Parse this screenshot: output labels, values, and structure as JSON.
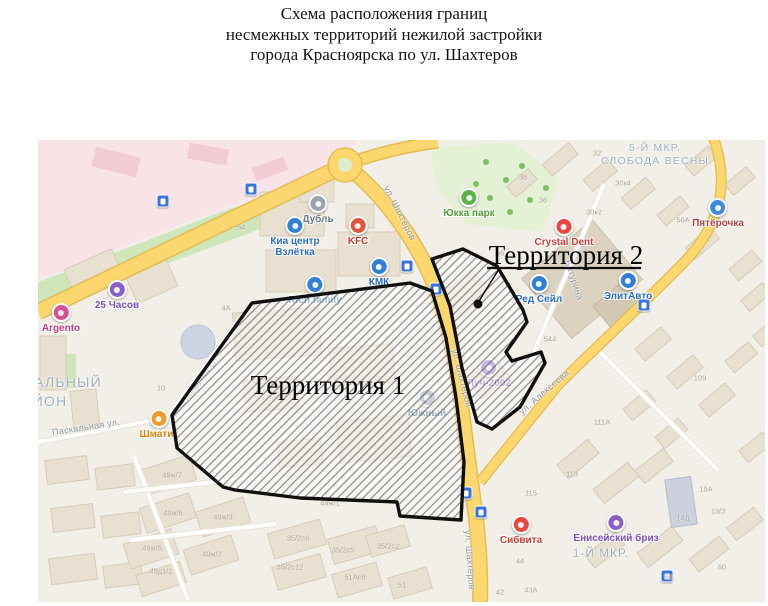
{
  "title": {
    "line1": "Схема расположения границ",
    "line2": "несмежных территорий нежилой застройки",
    "line3": "города Красноярска по ул. Шахтеров"
  },
  "territory_labels": [
    {
      "label": "Территория 1",
      "x": 290,
      "y": 230
    },
    {
      "label": "Территория 2",
      "x": 528,
      "y": 100
    }
  ],
  "district_labels": [
    {
      "t": "5-Й МКР.",
      "x": 617,
      "y": 2,
      "size": 10.5
    },
    {
      "t": "СЛОБОДА ВЕСНЫ",
      "x": 617,
      "y": 15,
      "size": 10.5
    },
    {
      "t": "1-Й МКР.",
      "x": 563,
      "y": 408,
      "size": 11.5
    },
    {
      "t": "АЛЬНЫЙ",
      "x": 30,
      "y": 234,
      "size": 14
    },
    {
      "t": "ЙОН",
      "x": 12,
      "y": 253,
      "size": 14
    }
  ],
  "street_labels": [
    {
      "t": "ул. Шахтёров",
      "x": 362,
      "y": 73,
      "rot": 63
    },
    {
      "t": "ул. Шахтёров",
      "x": 424,
      "y": 238,
      "rot": 76
    },
    {
      "t": "ул. Шахтёров",
      "x": 432,
      "y": 420,
      "rot": 86
    },
    {
      "t": "ул. Алексеева",
      "x": 506,
      "y": 252,
      "rot": -41
    },
    {
      "t": "Батурина",
      "x": 536,
      "y": 140,
      "rot": 72
    },
    {
      "t": "Абытаевская ул.",
      "x": 158,
      "y": 246,
      "rot": -53
    },
    {
      "t": "Паскальная ул.",
      "x": 48,
      "y": 287,
      "rot": -9
    }
  ],
  "pois": [
    {
      "t": "25 Часов",
      "x": 79,
      "y": 148,
      "c": "#8a5fc8",
      "lc": "#7a4fc0"
    },
    {
      "t": "Argento",
      "x": 23,
      "y": 171,
      "c": "#d94f93",
      "lc": "#c43c80"
    },
    {
      "t": "Шматик",
      "x": 121,
      "y": 277,
      "c": "#ef9a2e",
      "lc": "#d9820f"
    },
    {
      "t": "Дубль",
      "x": 280,
      "y": 62,
      "c": "#9aa3ab",
      "lc": "#6e7a85"
    },
    {
      "t": "Киа центр",
      "t2": "Взлётка",
      "x": 257,
      "y": 84,
      "c": "#2f80d6",
      "lc": "#2a6fc0"
    },
    {
      "t": "KFC",
      "x": 320,
      "y": 84,
      "c": "#e2543a",
      "lc": "#c23b2e"
    },
    {
      "t": "КМК",
      "x": 341,
      "y": 125,
      "c": "#2f80d6",
      "lc": "#2a6fc0"
    },
    {
      "t": "Rich family",
      "x": 277,
      "y": 143,
      "c": "#2f80d6",
      "lc": "#2a6fc0"
    },
    {
      "t": "Юкка парк",
      "x": 431,
      "y": 56,
      "c": "#59b347",
      "lc": "#4e9e38"
    },
    {
      "t": "Crystal Dent",
      "x": 526,
      "y": 85,
      "c": "#e8473f",
      "lc": "#d63c35"
    },
    {
      "t": "Пятёрочка",
      "x": 680,
      "y": 66,
      "c": "#3f8ae0",
      "lc": "#b0443c"
    },
    {
      "t": "Ред Сейл",
      "x": 501,
      "y": 142,
      "c": "#2f80d6",
      "lc": "#2a6fc0"
    },
    {
      "t": "ЭлитАвто",
      "x": 590,
      "y": 139,
      "c": "#2f80d6",
      "lc": "#2a6fc0"
    },
    {
      "t": "Луч-2002",
      "x": 451,
      "y": 226,
      "c": "#8a5fc8",
      "lc": "#7a4fc0"
    },
    {
      "t": "Южный",
      "x": 389,
      "y": 256,
      "c": "#8d99a3",
      "lc": "#33566e"
    },
    {
      "t": "Сибвита",
      "x": 483,
      "y": 383,
      "c": "#e8473f",
      "lc": "#d63c35"
    },
    {
      "t": "Енисейский бриз",
      "x": 578,
      "y": 381,
      "c": "#8a5fc8",
      "lc": "#7a4fc0"
    }
  ],
  "house_numbers": [
    {
      "t": "32",
      "x": 559,
      "y": 13
    },
    {
      "t": "30к4",
      "x": 585,
      "y": 43
    },
    {
      "t": "30к2",
      "x": 556,
      "y": 72
    },
    {
      "t": "50А",
      "x": 645,
      "y": 80
    },
    {
      "t": "36",
      "x": 505,
      "y": 60
    },
    {
      "t": "38",
      "x": 485,
      "y": 37
    },
    {
      "t": "66",
      "x": 462,
      "y": 113
    },
    {
      "t": "54",
      "x": 203,
      "y": 87
    },
    {
      "t": "544",
      "x": 512,
      "y": 199
    },
    {
      "t": "109",
      "x": 662,
      "y": 238
    },
    {
      "t": "111А",
      "x": 564,
      "y": 282
    },
    {
      "t": "113",
      "x": 534,
      "y": 334
    },
    {
      "t": "115",
      "x": 493,
      "y": 353
    },
    {
      "t": "19А",
      "x": 668,
      "y": 349
    },
    {
      "t": "19/3",
      "x": 680,
      "y": 371
    },
    {
      "t": "14Д",
      "x": 645,
      "y": 378
    },
    {
      "t": "60",
      "x": 684,
      "y": 427
    },
    {
      "t": "62",
      "x": 631,
      "y": 437
    },
    {
      "t": "44",
      "x": 482,
      "y": 421
    },
    {
      "t": "43А",
      "x": 493,
      "y": 450
    },
    {
      "t": "42",
      "x": 462,
      "y": 452
    },
    {
      "t": "4А",
      "x": 188,
      "y": 168
    },
    {
      "t": "10",
      "x": 123,
      "y": 248
    },
    {
      "t": "49ж/7",
      "x": 134,
      "y": 335
    },
    {
      "t": "49ж/6",
      "x": 135,
      "y": 373
    },
    {
      "t": "49ж/3",
      "x": 185,
      "y": 377
    },
    {
      "t": "49ж/5",
      "x": 114,
      "y": 408
    },
    {
      "t": "49ж/2",
      "x": 174,
      "y": 414
    },
    {
      "t": "49д1/2",
      "x": 123,
      "y": 431
    },
    {
      "t": "35/2с12",
      "x": 252,
      "y": 427
    },
    {
      "t": "35/2с6",
      "x": 260,
      "y": 398
    },
    {
      "t": "35/2с5",
      "x": 305,
      "y": 410
    },
    {
      "t": "35/2с2",
      "x": 350,
      "y": 406
    },
    {
      "t": "49ж/1",
      "x": 292,
      "y": 363
    },
    {
      "t": "51",
      "x": 364,
      "y": 445
    },
    {
      "t": "51Ас6",
      "x": 317,
      "y": 437
    }
  ],
  "transit_stops": [
    {
      "x": 125,
      "y": 61
    },
    {
      "x": 213,
      "y": 49
    },
    {
      "x": 369,
      "y": 126
    },
    {
      "x": 398,
      "y": 149
    },
    {
      "x": 428,
      "y": 353
    },
    {
      "x": 443,
      "y": 372
    },
    {
      "x": 606,
      "y": 165
    },
    {
      "x": 629,
      "y": 436
    }
  ],
  "colors": {
    "territory_border": "#101010",
    "hatch_line": "#3c3c3c",
    "main_road": "#fbd76d",
    "map_background": "#f2efe9"
  }
}
